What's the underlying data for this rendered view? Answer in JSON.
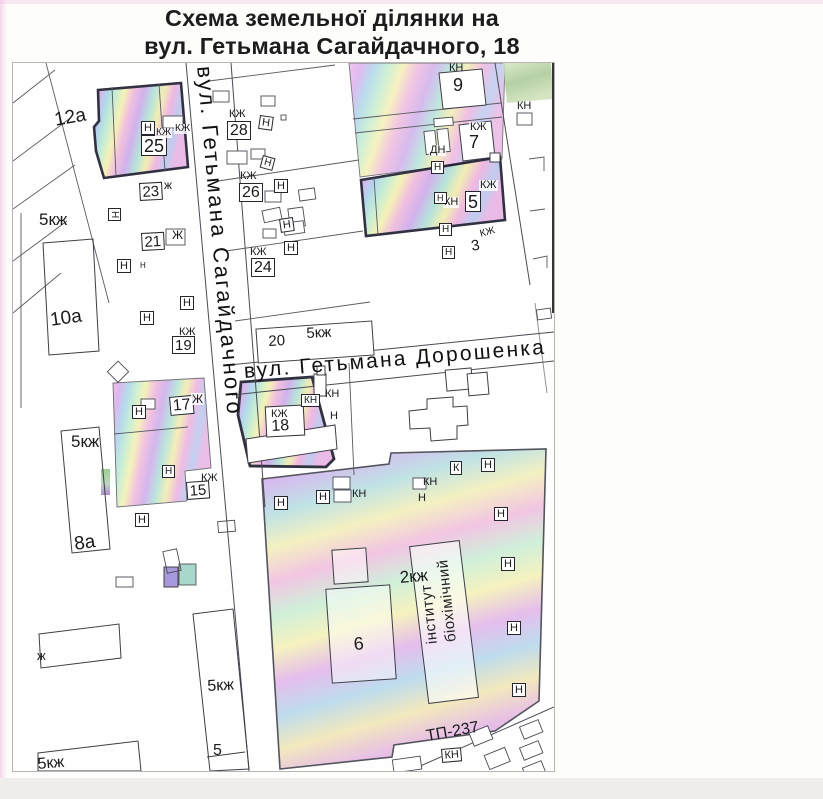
{
  "title": {
    "line1": "Схема земельної ділянки на",
    "line2": "вул. Гетьмана Сагайдачного, 18"
  },
  "streets": {
    "vertical": "вул. Гетьмана Сагайдачного",
    "horizontal": "вул. Гетьмана Дорошенка"
  },
  "institute": {
    "full": "біохімічний інститут",
    "column_left": "інститут",
    "column_right": "біохімічний"
  },
  "colors": {
    "highlight_pink": "#f2b8e8",
    "highlight_purple": "#cdaaeb",
    "highlight_cyan": "#aad4ea",
    "highlight_green": "#c0ecd0",
    "highlight_yellow": "#f4f0b0",
    "plot_border": "#1b1b2e",
    "line": "#4b4b55"
  },
  "map": {
    "labels": [
      {
        "t": "12а",
        "x": 40,
        "y": 48,
        "s": 19,
        "r": -10,
        "k": "t"
      },
      {
        "t": "5кж",
        "x": 26,
        "y": 148,
        "s": 17,
        "r": 0,
        "k": "t"
      },
      {
        "t": "Н",
        "x": 128,
        "y": 58,
        "s": 11,
        "r": 0,
        "k": "b"
      },
      {
        "t": "25",
        "x": 128,
        "y": 72,
        "s": 18,
        "r": 0,
        "k": "b"
      },
      {
        "t": "КЖ",
        "x": 142,
        "y": 65,
        "s": 10,
        "r": 0,
        "k": "p"
      },
      {
        "t": "КЖ",
        "x": 161,
        "y": 61,
        "s": 10,
        "r": 0,
        "k": "p"
      },
      {
        "t": "23",
        "x": 126,
        "y": 120,
        "s": 15,
        "r": -3,
        "k": "b"
      },
      {
        "t": "ж",
        "x": 151,
        "y": 116,
        "s": 12,
        "r": 0,
        "k": "t"
      },
      {
        "t": "Н",
        "x": 108,
        "y": 145,
        "s": 10,
        "r": 90,
        "k": "b"
      },
      {
        "t": "21",
        "x": 128,
        "y": 170,
        "s": 15,
        "r": -3,
        "k": "b"
      },
      {
        "t": "Ж",
        "x": 159,
        "y": 166,
        "s": 12,
        "r": 0,
        "k": "t"
      },
      {
        "t": "Н",
        "x": 104,
        "y": 196,
        "s": 11,
        "r": 0,
        "k": "b"
      },
      {
        "t": "Н",
        "x": 127,
        "y": 199,
        "s": 8,
        "r": 0,
        "k": "t"
      },
      {
        "t": "10а",
        "x": 36,
        "y": 248,
        "s": 19,
        "r": -8,
        "k": "t"
      },
      {
        "t": "Н",
        "x": 167,
        "y": 233,
        "s": 11,
        "r": 0,
        "k": "b"
      },
      {
        "t": "Н",
        "x": 127,
        "y": 248,
        "s": 11,
        "r": 0,
        "k": "b"
      },
      {
        "t": "КЖ",
        "x": 166,
        "y": 264,
        "s": 11,
        "r": 0,
        "k": "t"
      },
      {
        "t": "19",
        "x": 159,
        "y": 273,
        "s": 15,
        "r": 0,
        "k": "b"
      },
      {
        "t": "17",
        "x": 156,
        "y": 334,
        "s": 16,
        "r": -5,
        "k": "b"
      },
      {
        "t": "Ж",
        "x": 178,
        "y": 330,
        "s": 12,
        "r": 0,
        "k": "p"
      },
      {
        "t": "Н",
        "x": 119,
        "y": 342,
        "s": 11,
        "r": 0,
        "k": "b"
      },
      {
        "t": "5кж",
        "x": 58,
        "y": 370,
        "s": 17,
        "r": 0,
        "k": "t"
      },
      {
        "t": "Н",
        "x": 149,
        "y": 402,
        "s": 10,
        "r": 0,
        "k": "b"
      },
      {
        "t": "КЖ",
        "x": 188,
        "y": 410,
        "s": 11,
        "r": 0,
        "k": "t"
      },
      {
        "t": "15",
        "x": 173,
        "y": 419,
        "s": 15,
        "r": -4,
        "k": "b"
      },
      {
        "t": "Н",
        "x": 122,
        "y": 450,
        "s": 11,
        "r": 0,
        "k": "b"
      },
      {
        "t": "8а",
        "x": 60,
        "y": 472,
        "s": 19,
        "r": -8,
        "k": "t"
      },
      {
        "t": "ж",
        "x": 24,
        "y": 586,
        "s": 13,
        "r": 0,
        "k": "t"
      },
      {
        "t": "5кж",
        "x": 194,
        "y": 616,
        "s": 16,
        "r": -3,
        "k": "t"
      },
      {
        "t": "5",
        "x": 200,
        "y": 680,
        "s": 16,
        "r": 0,
        "k": "t"
      },
      {
        "t": "5кж",
        "x": 24,
        "y": 694,
        "s": 16,
        "r": -5,
        "k": "t"
      },
      {
        "t": "КЖ",
        "x": 216,
        "y": 46,
        "s": 11,
        "r": 0,
        "k": "t"
      },
      {
        "t": "28",
        "x": 214,
        "y": 58,
        "s": 16,
        "r": 0,
        "k": "b"
      },
      {
        "t": "Н",
        "x": 247,
        "y": 52,
        "s": 11,
        "r": 8,
        "k": "b"
      },
      {
        "t": "КЖ",
        "x": 227,
        "y": 108,
        "s": 11,
        "r": 0,
        "k": "t"
      },
      {
        "t": "26",
        "x": 226,
        "y": 120,
        "s": 16,
        "r": 0,
        "k": "b"
      },
      {
        "t": "Н",
        "x": 261,
        "y": 116,
        "s": 11,
        "r": 0,
        "k": "b"
      },
      {
        "t": "Н",
        "x": 250,
        "y": 92,
        "s": 10,
        "r": 15,
        "k": "b"
      },
      {
        "t": "КЖ",
        "x": 237,
        "y": 184,
        "s": 11,
        "r": 0,
        "k": "t"
      },
      {
        "t": "24",
        "x": 238,
        "y": 195,
        "s": 16,
        "r": 0,
        "k": "b"
      },
      {
        "t": "Н",
        "x": 271,
        "y": 178,
        "s": 11,
        "r": 0,
        "k": "b"
      },
      {
        "t": "Н",
        "x": 266,
        "y": 156,
        "s": 11,
        "r": -8,
        "k": "b"
      },
      {
        "t": "20",
        "x": 255,
        "y": 271,
        "s": 15,
        "r": -3,
        "k": "t"
      },
      {
        "t": "5кж",
        "x": 293,
        "y": 263,
        "s": 15,
        "r": -3,
        "k": "t"
      },
      {
        "t": "КН",
        "x": 436,
        "y": 0,
        "s": 11,
        "r": 0,
        "k": "t"
      },
      {
        "t": "9",
        "x": 440,
        "y": 13,
        "s": 18,
        "r": 0,
        "k": "t"
      },
      {
        "t": "КЖ",
        "x": 456,
        "y": 59,
        "s": 11,
        "r": 0,
        "k": "p"
      },
      {
        "t": "7",
        "x": 456,
        "y": 70,
        "s": 18,
        "r": 0,
        "k": "t"
      },
      {
        "t": "ДН",
        "x": 416,
        "y": 82,
        "s": 11,
        "r": 0,
        "k": "p"
      },
      {
        "t": "Н",
        "x": 418,
        "y": 98,
        "s": 10,
        "r": 0,
        "k": "b"
      },
      {
        "t": "КЖ",
        "x": 466,
        "y": 117,
        "s": 11,
        "r": 0,
        "k": "p"
      },
      {
        "t": "5",
        "x": 452,
        "y": 128,
        "s": 18,
        "r": 0,
        "k": "b"
      },
      {
        "t": "КН",
        "x": 430,
        "y": 134,
        "s": 11,
        "r": 0,
        "k": "p"
      },
      {
        "t": "Н",
        "x": 421,
        "y": 129,
        "s": 9,
        "r": 0,
        "k": "b"
      },
      {
        "t": "Н",
        "x": 426,
        "y": 160,
        "s": 10,
        "r": 0,
        "k": "b"
      },
      {
        "t": "Н",
        "x": 429,
        "y": 183,
        "s": 10,
        "r": 0,
        "k": "b"
      },
      {
        "t": "3",
        "x": 457,
        "y": 176,
        "s": 15,
        "r": -10,
        "k": "t"
      },
      {
        "t": "КЖ",
        "x": 466,
        "y": 167,
        "s": 10,
        "r": -15,
        "k": "t"
      },
      {
        "t": "КН",
        "x": 504,
        "y": 38,
        "s": 11,
        "r": 0,
        "k": "t"
      },
      {
        "t": "КЖ",
        "x": 257,
        "y": 346,
        "s": 11,
        "r": 0,
        "k": "p"
      },
      {
        "t": "18",
        "x": 258,
        "y": 356,
        "s": 16,
        "r": -3,
        "k": "t"
      },
      {
        "t": "КН",
        "x": 288,
        "y": 331,
        "s": 10,
        "r": 0,
        "k": "b"
      },
      {
        "t": "КН",
        "x": 312,
        "y": 326,
        "s": 11,
        "r": 0,
        "k": "t"
      },
      {
        "t": "Н",
        "x": 317,
        "y": 348,
        "s": 11,
        "r": 0,
        "k": "t"
      },
      {
        "t": "Н",
        "x": 261,
        "y": 433,
        "s": 11,
        "r": 0,
        "k": "b"
      },
      {
        "t": "Н",
        "x": 303,
        "y": 427,
        "s": 11,
        "r": 0,
        "k": "b"
      },
      {
        "t": "КН",
        "x": 339,
        "y": 426,
        "s": 11,
        "r": 0,
        "k": "t"
      },
      {
        "t": "КН",
        "x": 410,
        "y": 414,
        "s": 11,
        "r": 0,
        "k": "t"
      },
      {
        "t": "Н",
        "x": 405,
        "y": 430,
        "s": 11,
        "r": 0,
        "k": "t"
      },
      {
        "t": "К",
        "x": 437,
        "y": 398,
        "s": 11,
        "r": 0,
        "k": "b"
      },
      {
        "t": "Н",
        "x": 468,
        "y": 395,
        "s": 11,
        "r": 0,
        "k": "b"
      },
      {
        "t": "Н",
        "x": 481,
        "y": 444,
        "s": 11,
        "r": 0,
        "k": "b"
      },
      {
        "t": "Н",
        "x": 488,
        "y": 494,
        "s": 11,
        "r": 0,
        "k": "b"
      },
      {
        "t": "Н",
        "x": 494,
        "y": 558,
        "s": 11,
        "r": 0,
        "k": "b"
      },
      {
        "t": "Н",
        "x": 499,
        "y": 620,
        "s": 11,
        "r": 0,
        "k": "b"
      },
      {
        "t": "2кж",
        "x": 386,
        "y": 506,
        "s": 17,
        "r": -5,
        "k": "t"
      },
      {
        "t": "6",
        "x": 340,
        "y": 572,
        "s": 18,
        "r": -5,
        "k": "t"
      },
      {
        "t": "ТП-237",
        "x": 412,
        "y": 666,
        "s": 16,
        "r": -10,
        "k": "t"
      },
      {
        "t": "КН",
        "x": 428,
        "y": 686,
        "s": 11,
        "r": -5,
        "k": "b"
      }
    ]
  }
}
